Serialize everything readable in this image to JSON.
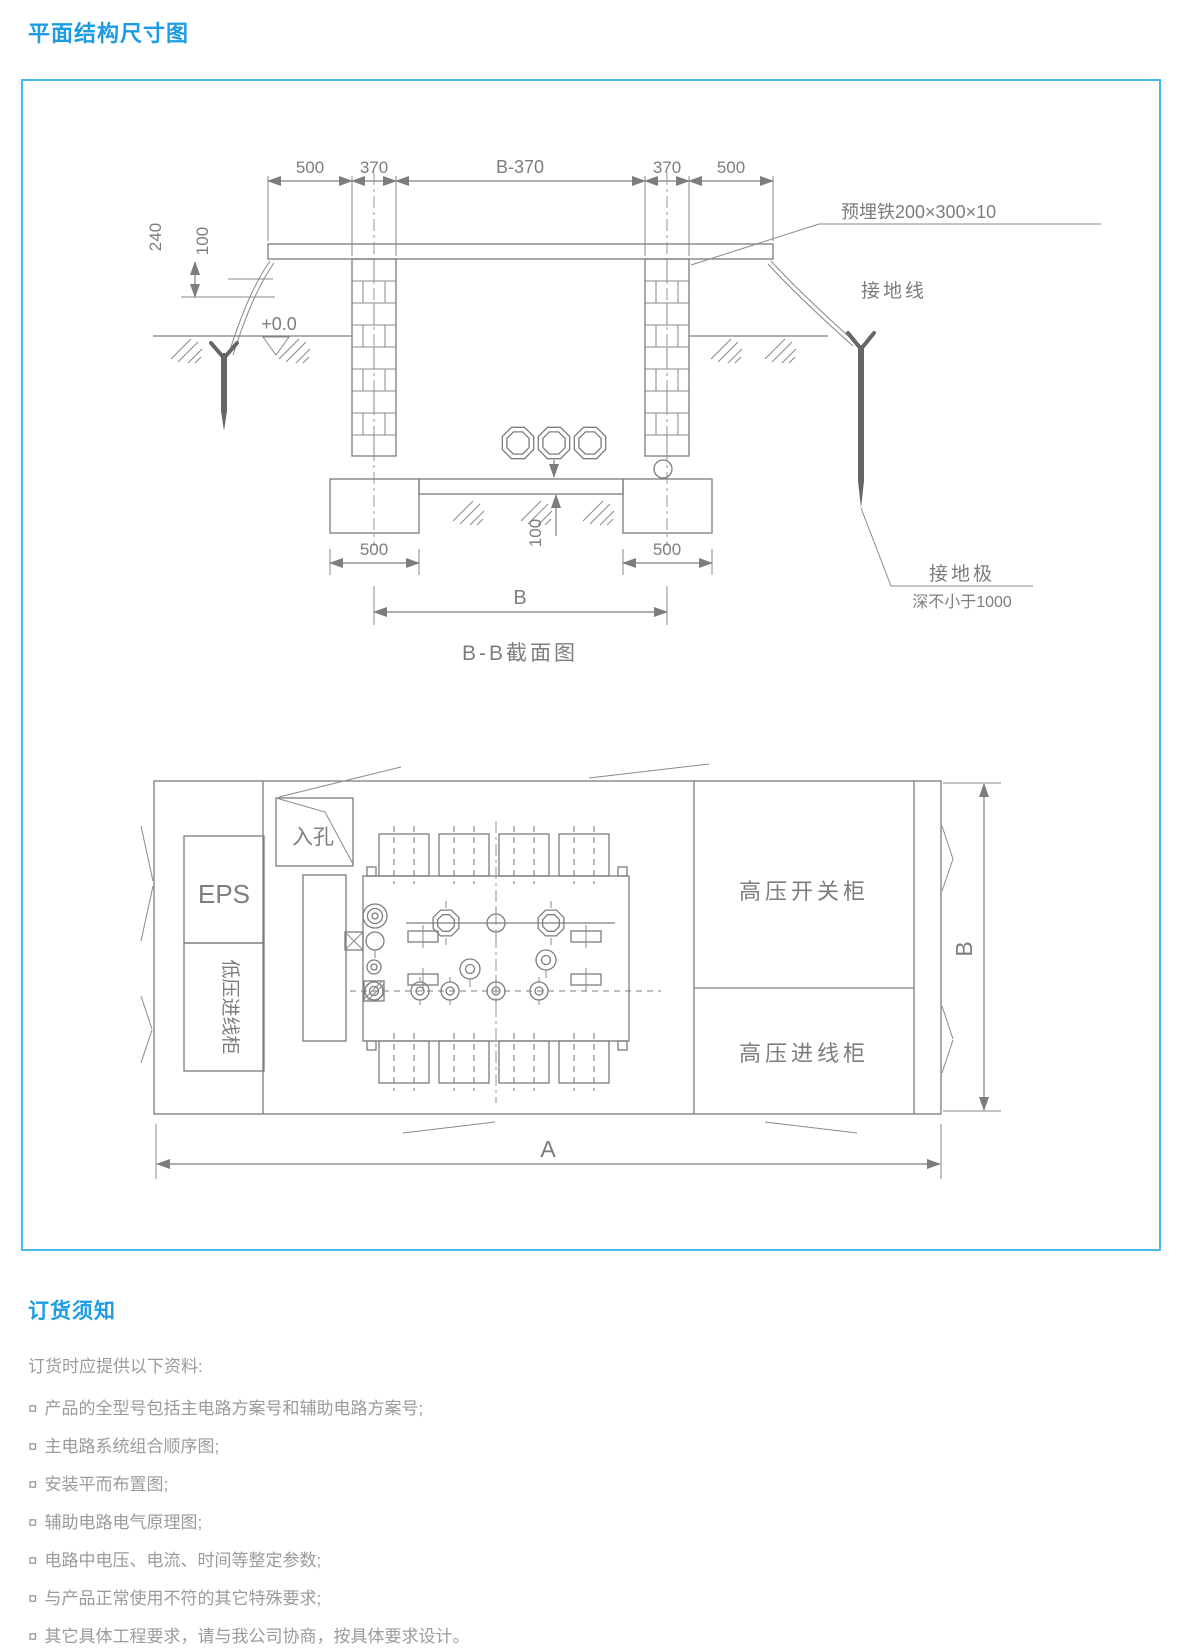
{
  "page": {
    "title": "平面结构尺寸图"
  },
  "colors": {
    "accent": "#1b9ce4",
    "frame_border": "#45b8ef",
    "line": "#7d7d7d",
    "body_text": "#9b9b9b"
  },
  "section_view": {
    "caption": "B-B截面图",
    "dims": {
      "top_1": "500",
      "top_2": "370",
      "top_3": "B-370",
      "top_4": "370",
      "top_5": "500",
      "left_outer": "240",
      "left_inner": "100",
      "level": "+0.0",
      "bed": "100",
      "bottom_left": "500",
      "bottom_right": "500",
      "span": "B"
    },
    "notes": {
      "embedded_plate": "预埋铁200×300×10",
      "ground_wire": "接地线",
      "ground_rod": "接地极",
      "ground_rod_depth": "深不小于1000"
    }
  },
  "plan_view": {
    "manhole": "入孔",
    "eps": "EPS",
    "lv_incoming": "低压进线柜",
    "hv_switchgear": "高压开关柜",
    "hv_incoming": "高压进线柜",
    "dim_width": "B",
    "dim_length": "A"
  },
  "ordering": {
    "heading": "订货须知",
    "intro": "订货时应提供以下资料:",
    "bullet": "¤",
    "items": [
      "产品的全型号包括主电路方案号和辅助电路方案号;",
      "主电路系统组合顺序图;",
      "安装平而布置图;",
      "辅助电路电气原理图;",
      "电路中电压、电流、时间等整定参数;",
      "与产品正常使用不符的其它特殊要求;",
      "其它具体工程要求，请与我公司协商，按具体要求设计。"
    ]
  }
}
